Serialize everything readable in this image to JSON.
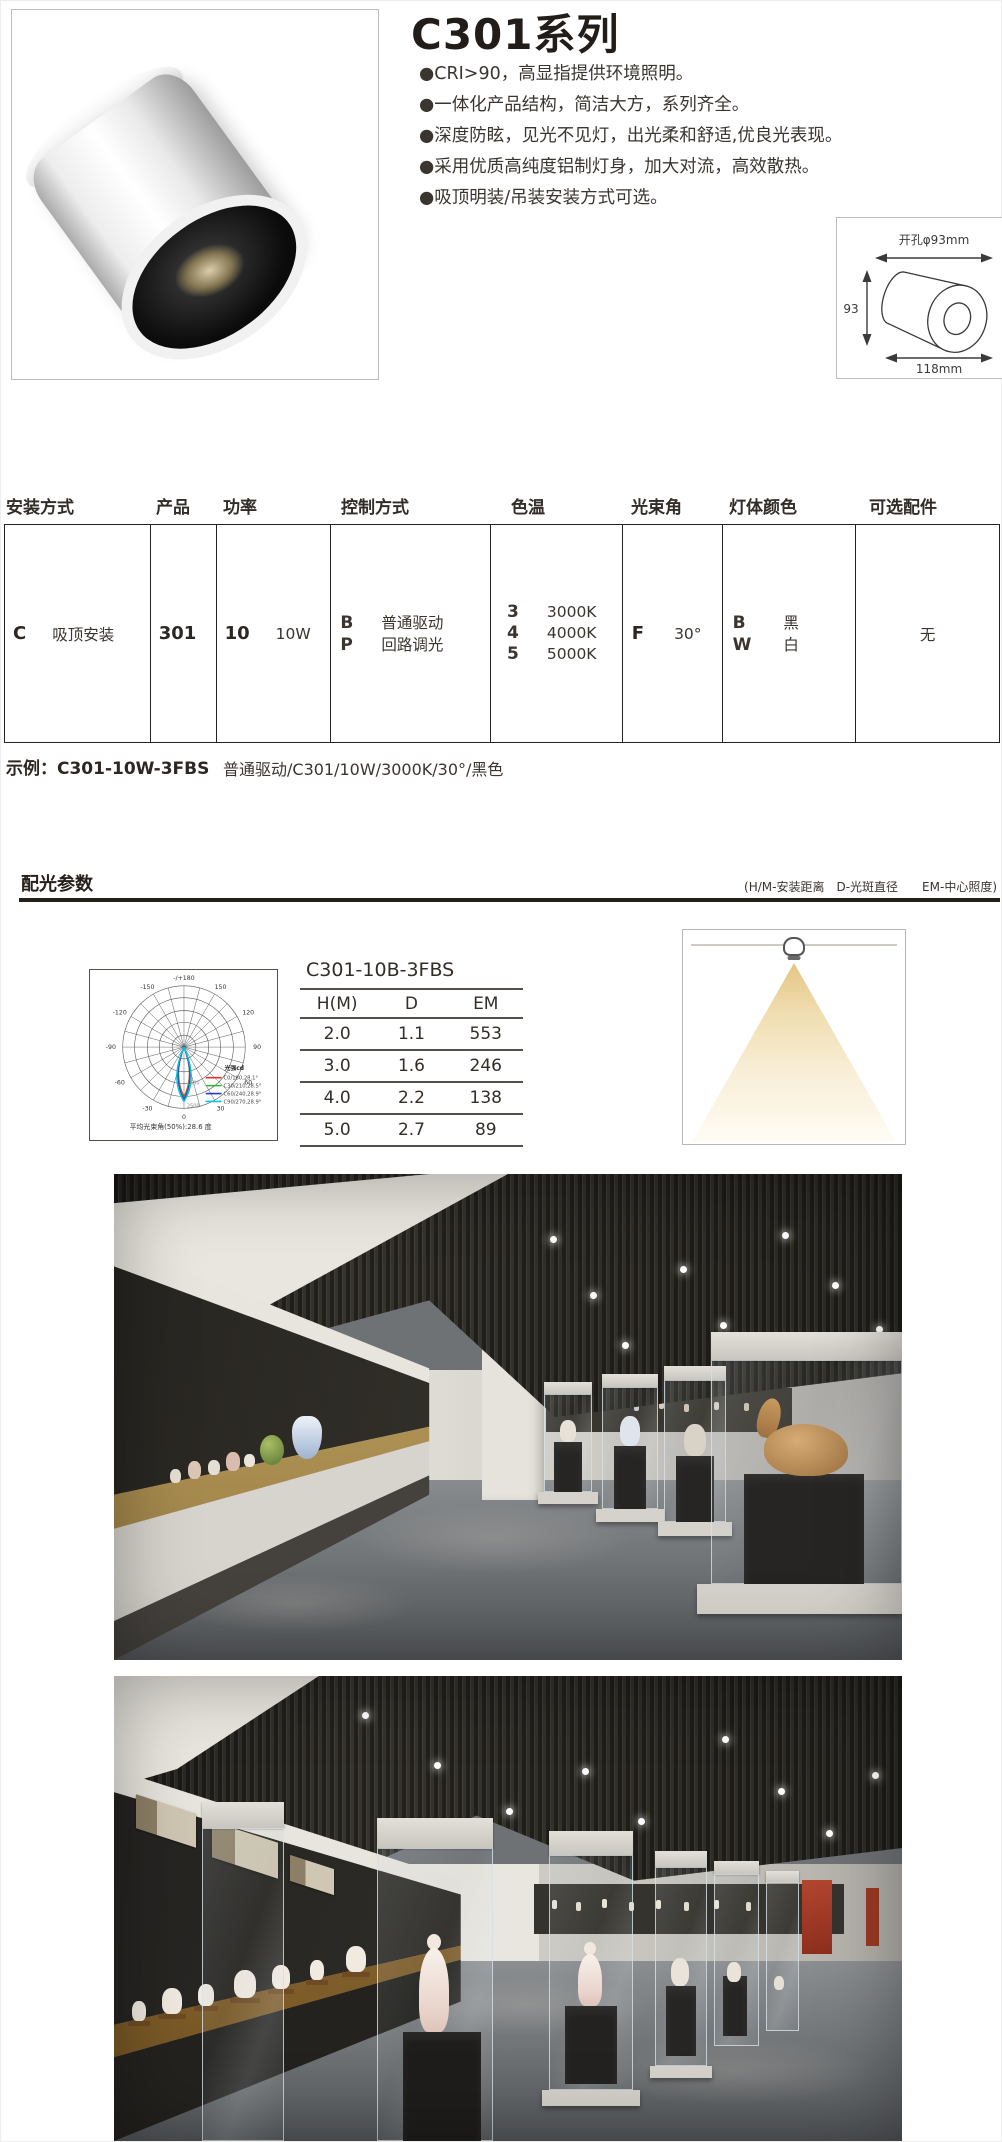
{
  "header": {
    "title": "C301系列",
    "bullets": [
      "●CRI>90，高显指提供环境照明。",
      "●一体化产品结构，简洁大方，系列齐全。",
      "●深度防眩，见光不见灯，出光柔和舒适,优良光表现。",
      "●采用优质高纯度铝制灯身，加大对流，高效散热。",
      "●吸顶明装/吊装安装方式可选。"
    ]
  },
  "product_image": {
    "description": "白色圆柱形明装筒灯产品照片"
  },
  "dimensions": {
    "hole": "开孔φ93mm",
    "height": "93",
    "length": "118mm"
  },
  "spec_table": {
    "headers": [
      "安装方式",
      "产品",
      "功率",
      "控制方式",
      "色温",
      "光束角",
      "灯体颜色",
      "可选配件"
    ],
    "install": {
      "code": "C",
      "text": "吸顶安装"
    },
    "product": "301",
    "power": {
      "code": "10",
      "text": "10W"
    },
    "control": {
      "codes": [
        "B",
        "P"
      ],
      "texts": [
        "普通驱动",
        "回路调光"
      ]
    },
    "cct": {
      "codes": [
        "3",
        "4",
        "5"
      ],
      "texts": [
        "3000K",
        "4000K",
        "5000K"
      ]
    },
    "beam": {
      "code": "F",
      "text": "30°"
    },
    "body_color": {
      "codes": [
        "B",
        "W"
      ],
      "texts": [
        "黑",
        "白"
      ]
    },
    "accessory": "无",
    "example_label": "示例：C301-10W-3FBS",
    "example_value": "普通驱动/C301/10W/3000K/30°/黑色"
  },
  "photometry": {
    "section_title": "配光参数",
    "note": "(H/M-安装距离　D-光斑直径　　EM-中心照度)",
    "polar": {
      "angle_labels": [
        "-/+180",
        "-150",
        "150",
        "-120",
        "120",
        "-90",
        "90",
        "-60",
        "60",
        "-30",
        "30",
        "0"
      ],
      "ring_labels": [
        "1500",
        "2500"
      ],
      "legend_title": "光强cd",
      "legend": [
        {
          "label": "C0/180,28.1°",
          "color": "#e03030"
        },
        {
          "label": "C30/210,28.5°",
          "color": "#2ab52a"
        },
        {
          "label": "C60/240,28.9°",
          "color": "#2738c8"
        },
        {
          "label": "C90/270,28.9°",
          "color": "#00c6e6"
        }
      ],
      "avg_beam": "平均光束角(50%):28.6 度"
    },
    "table": {
      "title": "C301-10B-3FBS",
      "columns": [
        "H(M)",
        "D",
        "EM"
      ],
      "rows": [
        [
          "2.0",
          "1.1",
          "553"
        ],
        [
          "3.0",
          "1.6",
          "246"
        ],
        [
          "4.0",
          "2.2",
          "138"
        ],
        [
          "5.0",
          "2.7",
          "89"
        ]
      ]
    }
  },
  "photos": [
    {
      "description": "博物馆展厅照片：深色格栅天花板筒灯照明，左侧通柜陈列瓷器，右侧独立玻璃展柜内陈列陶塑兽形展品"
    },
    {
      "description": "博物馆展厅照片：格栅天花板筒灯照明，左右通柜与独立玻璃展柜陈列白瓷人物塑像"
    }
  ]
}
